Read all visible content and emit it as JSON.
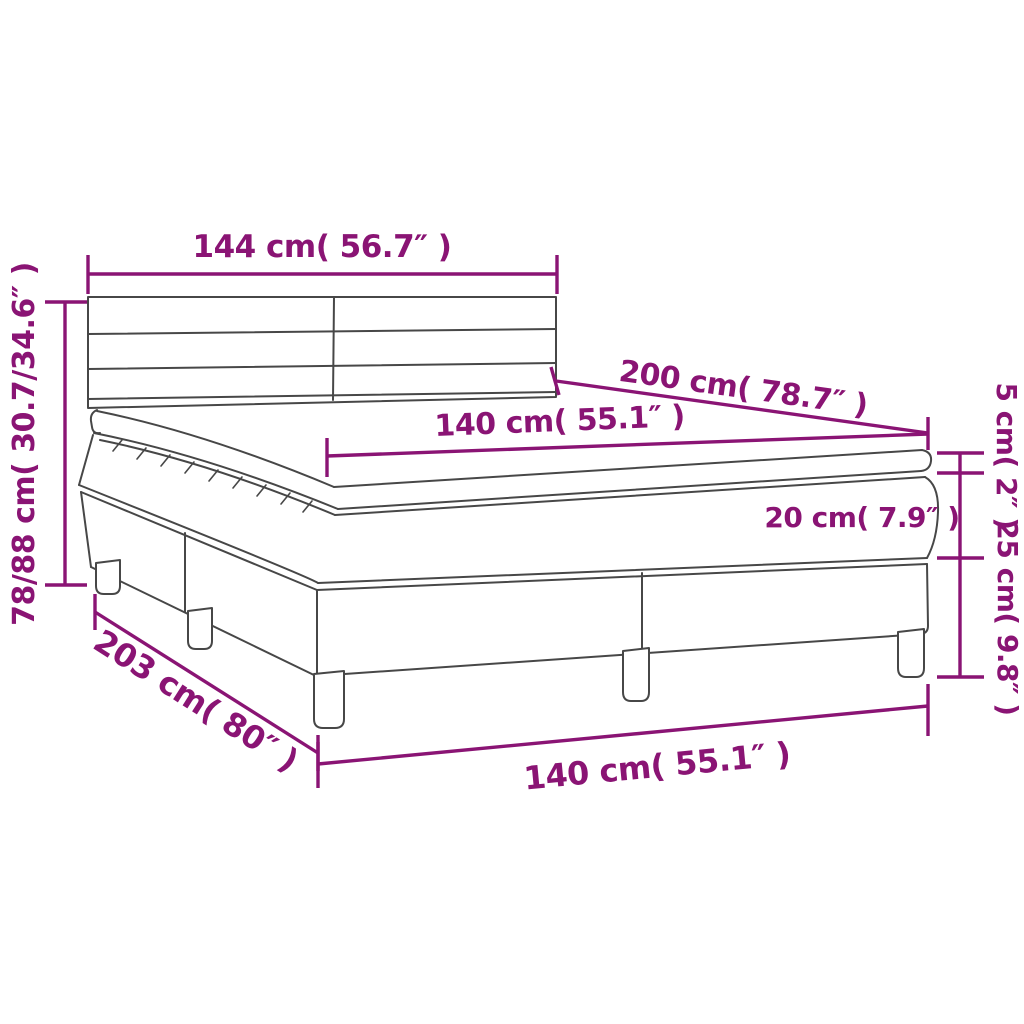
{
  "diagram": {
    "title": "box-spring-bed-dimension-diagram",
    "colors": {
      "accent": "#8A1474",
      "outline": "#474747",
      "background": "#ffffff"
    },
    "dimensions": {
      "headboard_width": "144 cm( 56.7″ )",
      "total_height": "78/88 cm( 30.7/34.6″ )",
      "bed_length": "200 cm( 78.7″ )",
      "mattress_width_top": "140 cm( 55.1″ )",
      "topper_height": "5 cm( 2″ )",
      "mattress_height": "20 cm( 7.9″ )",
      "box_height": "25 cm( 9.8″ )",
      "total_length": "203 cm( 80″ )",
      "mattress_width_bottom": "140 cm( 55.1″ )"
    }
  }
}
